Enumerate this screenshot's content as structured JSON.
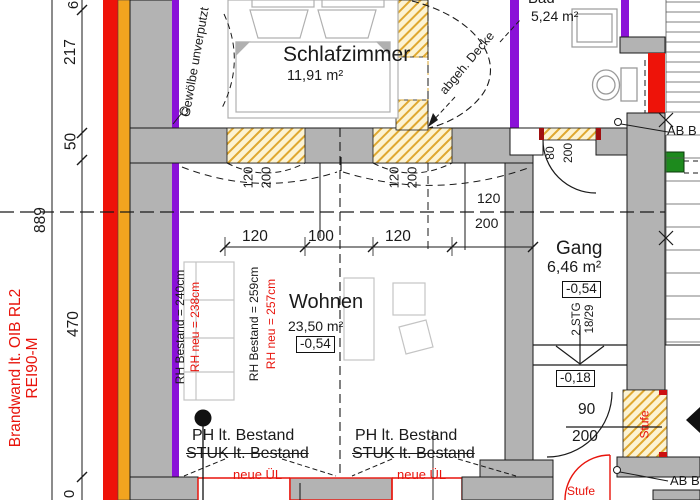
{
  "rooms": {
    "schlafzimmer": {
      "name": "Schlafzimmer",
      "area": "11,91 m²"
    },
    "bad": {
      "name": "Bad",
      "area": "5,24 m²"
    },
    "wohnen": {
      "name": "Wohnen",
      "area": "23,50 m²",
      "level": "-0,54"
    },
    "gang": {
      "name": "Gang",
      "area": "6,46 m²",
      "level": "-0,54",
      "landing_level": "-0,18"
    }
  },
  "dims": {
    "total_height": "889",
    "seg_6": "6",
    "seg_217": "217",
    "seg_50": "50",
    "seg_470": "470",
    "seg_last": "0",
    "span_120a": "120",
    "span_100": "100",
    "span_120b": "120",
    "win1_w": "120",
    "win1_h": "200",
    "win2_w": "120",
    "win2_h": "200",
    "opening_w": "120",
    "opening_h": "200",
    "bad_door_w": "80",
    "bad_door_h": "200",
    "stufe_door_w": "90",
    "stufe_door_h": "200"
  },
  "notes": {
    "brandwand1": "Brandwand lt. OIB RL2",
    "brandwand2": "REI90-M",
    "gewoelbe": "Gewölbe unverputzt",
    "decke": "abgeh. Decke",
    "rh1_b": "RH Bestand = 240cm",
    "rh1_n": "RH neu = 238cm",
    "rh2_b": "RH Bestand = 259cm",
    "rh2_n": "RH neu = 257cm",
    "ph": "PH lt. Bestand",
    "stuk": "STUK lt. Bestand",
    "neue_ul": "neue ÜL",
    "stg_count": "2 STG",
    "stg_size": "18/29",
    "stufe": "Stufe",
    "ab": "AB B"
  },
  "colors": {
    "brandwand_red": "#ee1309",
    "insulation_orange": "#f2a41f",
    "new_wall_purple": "#8a12d8",
    "existing_wall_gray": "#b3b3b3",
    "hatch_yellow": "#dfa830",
    "accent_green": "#1d8a1d",
    "new_element_red": "#e8140c"
  }
}
